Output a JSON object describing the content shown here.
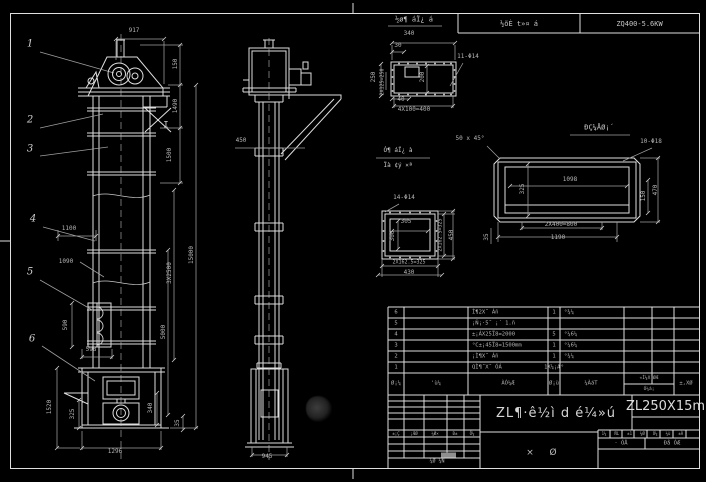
{
  "colors": {
    "background": "#000000",
    "linework": "#dedede",
    "dim_text": "#b5b5b5"
  },
  "header_strip": {
    "gearbox_label": "½õÈ t»¤ á",
    "gearbox_model": "ZQ400-5.6KW"
  },
  "titleblock": {
    "drawing_title": "ZL¶·ê½ì d é¼»ú",
    "model": "ZL250X15m",
    "type_chars": [
      "×",
      "Ø"
    ],
    "sig_row": [
      "±¡Ç",
      "¡ÆØ",
      "¼Ø×",
      "Ð±",
      "Õ¼"
    ],
    "bottom_label": "¼Ø ¼Ñ",
    "right_tiny": [
      "1¼",
      "ÑL",
      "±1",
      "¼Ø",
      "Ó¼",
      "¼ù",
      "±À"
    ],
    "right_cells": [
      "· ÓÅ",
      "Ðå ÓÆ"
    ]
  },
  "bom": {
    "col_headers": {
      "no": "Ø¡¼",
      "dwg": "'ù¼",
      "name": "ÀÓ¼Æ",
      "qty": "Ø¡ù",
      "mat": "¼ÀáT",
      "total_top": "«Ì¼X¡ØÆ",
      "total_bottom": "Ó¼á¡",
      "remark": "±,XØ"
    },
    "rows": [
      {
        "no": "6",
        "name": "Ì¶2X˝ Áñ",
        "qty": "1",
        "mat": "°¾¼"
      },
      {
        "no": "5",
        "name": "¡Ñ¡·5˝ ¡´ 1.ñ",
        "qty": "",
        "mat": ""
      },
      {
        "no": "4",
        "name": "±¡ÁX25Ï8=2000",
        "qty": "5",
        "mat": "°¼6¼"
      },
      {
        "no": "3",
        "name": "°C±¡45Ï8=1500mm",
        "qty": "1",
        "mat": "°¼6¼"
      },
      {
        "no": "2",
        "name": "¡Ì¶X˝ Áñ",
        "qty": "1",
        "mat": "°¾¼"
      },
      {
        "no": "1",
        "name": "QÌ¶˝X˝ ÓÁ",
        "qty": "1X¼¡Æ°",
        "mat": ""
      }
    ]
  },
  "balloons": [
    {
      "n": "1",
      "x": 30,
      "y": 44
    },
    {
      "n": "2",
      "x": 30,
      "y": 120
    },
    {
      "n": "3",
      "x": 30,
      "y": 149
    },
    {
      "n": "4",
      "x": 33,
      "y": 219
    },
    {
      "n": "5",
      "x": 30,
      "y": 272
    },
    {
      "n": "6",
      "x": 32,
      "y": 339
    }
  ],
  "annotations": [
    {
      "t": "917",
      "x": 134,
      "y": 31
    },
    {
      "t": "150",
      "x": 176,
      "y": 64,
      "r": 1
    },
    {
      "t": "1490",
      "x": 176,
      "y": 106,
      "r": 1
    },
    {
      "t": "1500",
      "x": 170,
      "y": 155,
      "r": 1
    },
    {
      "t": "15000",
      "x": 192,
      "y": 255,
      "r": 1
    },
    {
      "t": "3X2500",
      "x": 170,
      "y": 273,
      "r": 1
    },
    {
      "t": "5000",
      "x": 164,
      "y": 332,
      "r": 1
    },
    {
      "t": "1100",
      "x": 69,
      "y": 229
    },
    {
      "t": "1090",
      "x": 66,
      "y": 262
    },
    {
      "t": "590",
      "x": 66,
      "y": 325,
      "r": 1
    },
    {
      "t": "598",
      "x": 91,
      "y": 350
    },
    {
      "t": "1520",
      "x": 50,
      "y": 407,
      "r": 1
    },
    {
      "t": "325",
      "x": 73,
      "y": 414,
      "r": 1
    },
    {
      "t": "340",
      "x": 151,
      "y": 408,
      "r": 1
    },
    {
      "t": "35",
      "x": 178,
      "y": 423,
      "r": 1
    },
    {
      "t": "1296",
      "x": 115,
      "y": 452
    },
    {
      "t": "I",
      "x": 166,
      "y": 126,
      "s": 9,
      "c": "lbl"
    },
    {
      "t": "450",
      "x": 241,
      "y": 141
    },
    {
      "t": "945",
      "x": 267,
      "y": 457
    },
    {
      "t": "½ø¶ áÏ¿ á",
      "x": 414,
      "y": 20,
      "s": 7,
      "c": "lbl"
    },
    {
      "t": "340",
      "x": 409,
      "y": 34
    },
    {
      "t": "30",
      "x": 398,
      "y": 46
    },
    {
      "t": "11-Φ14",
      "x": 468,
      "y": 57
    },
    {
      "t": "250",
      "x": 374,
      "y": 77,
      "r": 1
    },
    {
      "t": "2X125=250",
      "x": 383,
      "y": 82,
      "r": 1,
      "s": 5
    },
    {
      "t": "200",
      "x": 423,
      "y": 77,
      "r": 1
    },
    {
      "t": "40",
      "x": 401,
      "y": 100
    },
    {
      "t": "4X100=400",
      "x": 414,
      "y": 110
    },
    {
      "t": "50 x 45°",
      "x": 470,
      "y": 139
    },
    {
      "t": "ÐÇ¼ÅØ¡´",
      "x": 599,
      "y": 128,
      "s": 7,
      "c": "lbl"
    },
    {
      "t": "10-Φ18",
      "x": 651,
      "y": 142
    },
    {
      "t": "1098",
      "x": 570,
      "y": 180
    },
    {
      "t": "325",
      "x": 523,
      "y": 189,
      "r": 1
    },
    {
      "t": "150",
      "x": 644,
      "y": 196,
      "r": 1
    },
    {
      "t": "470",
      "x": 656,
      "y": 190,
      "r": 1
    },
    {
      "t": "2X400=800",
      "x": 561,
      "y": 225
    },
    {
      "t": "1190",
      "x": 558,
      "y": 238
    },
    {
      "t": "35",
      "x": 487,
      "y": 237,
      "r": 1
    },
    {
      "t": "Ó¶ áÏ¿ à",
      "x": 398,
      "y": 151,
      "s": 6,
      "c": "lbl"
    },
    {
      "t": "Ïà ¢ý ×ª",
      "x": 398,
      "y": 166,
      "s": 6,
      "c": "lbl"
    },
    {
      "t": "14-Φ14",
      "x": 404,
      "y": 198
    },
    {
      "t": "305",
      "x": 406,
      "y": 222
    },
    {
      "t": "300",
      "x": 393,
      "y": 236,
      "r": 1
    },
    {
      "t": "2X162.5=325",
      "x": 441,
      "y": 235,
      "r": 1,
      "s": 5
    },
    {
      "t": "450",
      "x": 452,
      "y": 235,
      "r": 1
    },
    {
      "t": "2X162.5=325",
      "x": 409,
      "y": 263,
      "s": 5
    },
    {
      "t": "430",
      "x": 409,
      "y": 273
    }
  ]
}
